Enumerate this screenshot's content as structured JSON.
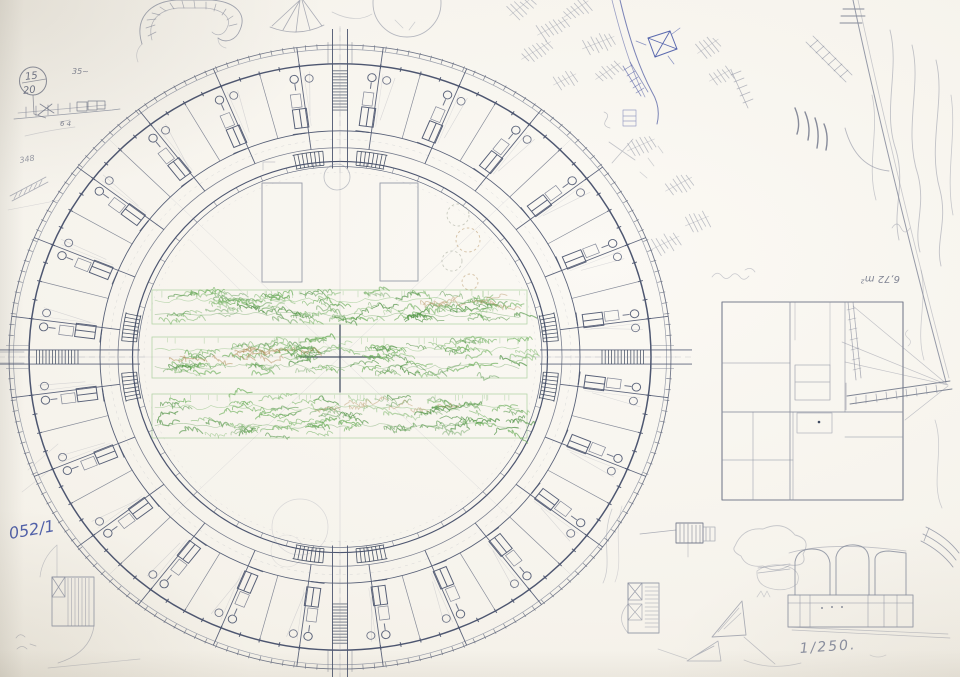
{
  "sheet": {
    "description": "hand-drafted circular apartment building floor plan with perimeter concept sketches",
    "scale": "1:250"
  },
  "annotations": {
    "circled_note_top": "15",
    "circled_note_bottom": "20",
    "measure_note": "35~",
    "section_dim": "6 4",
    "left_scribble": "348",
    "sheet_code": "052/1",
    "area_label": "6,72 m²",
    "scale_label": "1/250."
  },
  "palette": {
    "paper": "#f6f3ec",
    "graphite_faint": "#a9adb8",
    "graphite": "#8b90a0",
    "graphite_dark": "#6a7184",
    "drafting": "#4d5670",
    "drafting_dark": "#3f4a60",
    "ink_blue": "#3f51a3",
    "sketch_blue": "#5b66a8",
    "green": "#74b363",
    "green_dark": "#55964a",
    "brown": "#b08b58",
    "sage": "#9aa08e"
  }
}
